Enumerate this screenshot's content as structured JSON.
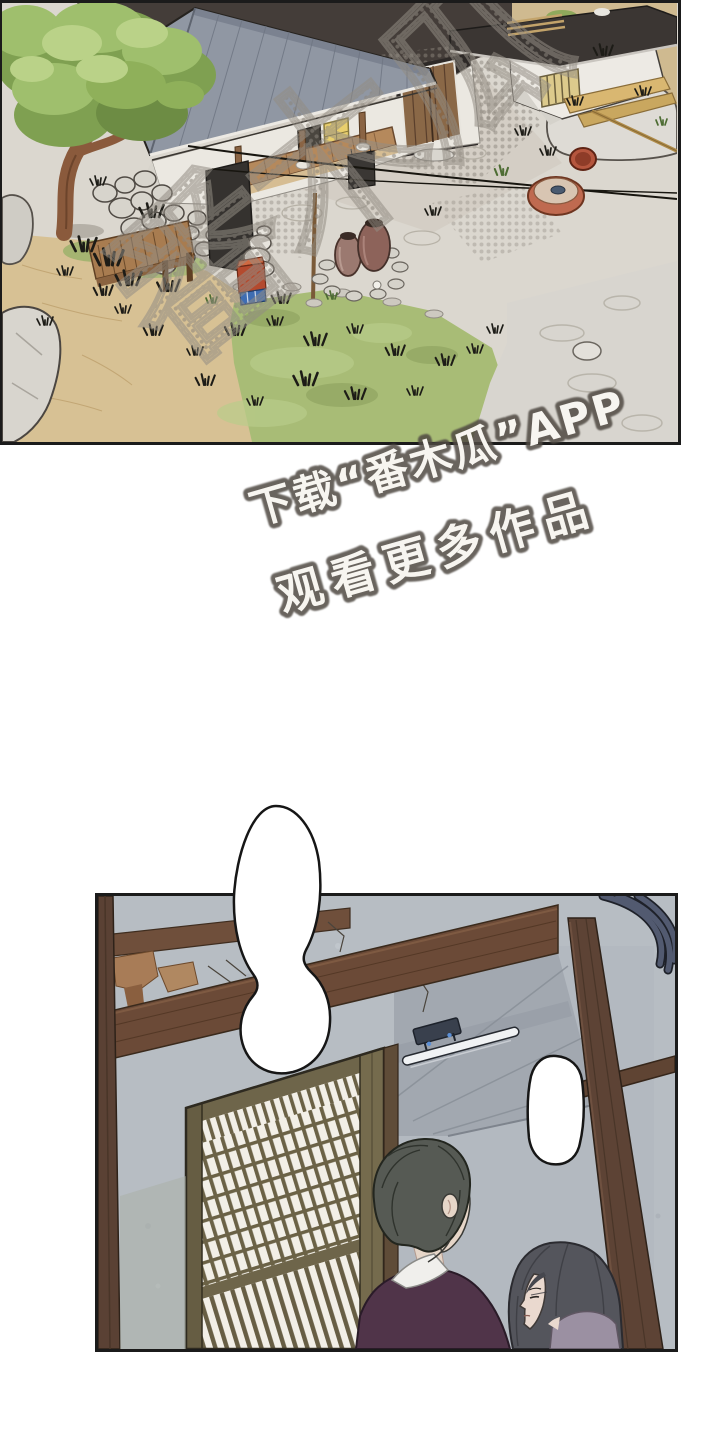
{
  "page": {
    "background_color": "#ffffff",
    "media_type": "webtoon comic page"
  },
  "panels": {
    "courtyard": {
      "label": "hanok courtyard exterior, aerial view",
      "palette": {
        "roof": "#9097a3",
        "dark_backdrop": "#443d39",
        "courtyard_stone": "#dbd7cf",
        "sand": "#d7c194",
        "grass": "#a8bc76",
        "tree_foliage": "#9fbf6d",
        "wood": "#a87c50",
        "shed_roof": "#3b3633",
        "jar": "#8d635a",
        "red_tub": "#bf6a50"
      }
    },
    "interior": {
      "label": "hanok interior with lattice door, man and woman",
      "palette": {
        "wall": "#b7bdc3",
        "beam": "#6b4a37",
        "lattice_wood": "#6b6246",
        "paper": "#f2efe7",
        "man_jacket": "#503449",
        "woman_top": "#9b90a2",
        "hair": "#565a54"
      }
    }
  },
  "watermark": {
    "brand_text": "番木瓜",
    "download_line": "下载“番木瓜”APP",
    "watch_line": "观看更多作品",
    "text_fill": "#f7f5f0",
    "text_outline": "#4f4a43",
    "brand_dot_color": "#8b857c"
  },
  "speech_bubbles": {
    "large": {
      "text": ""
    },
    "small": {
      "text": ""
    }
  }
}
